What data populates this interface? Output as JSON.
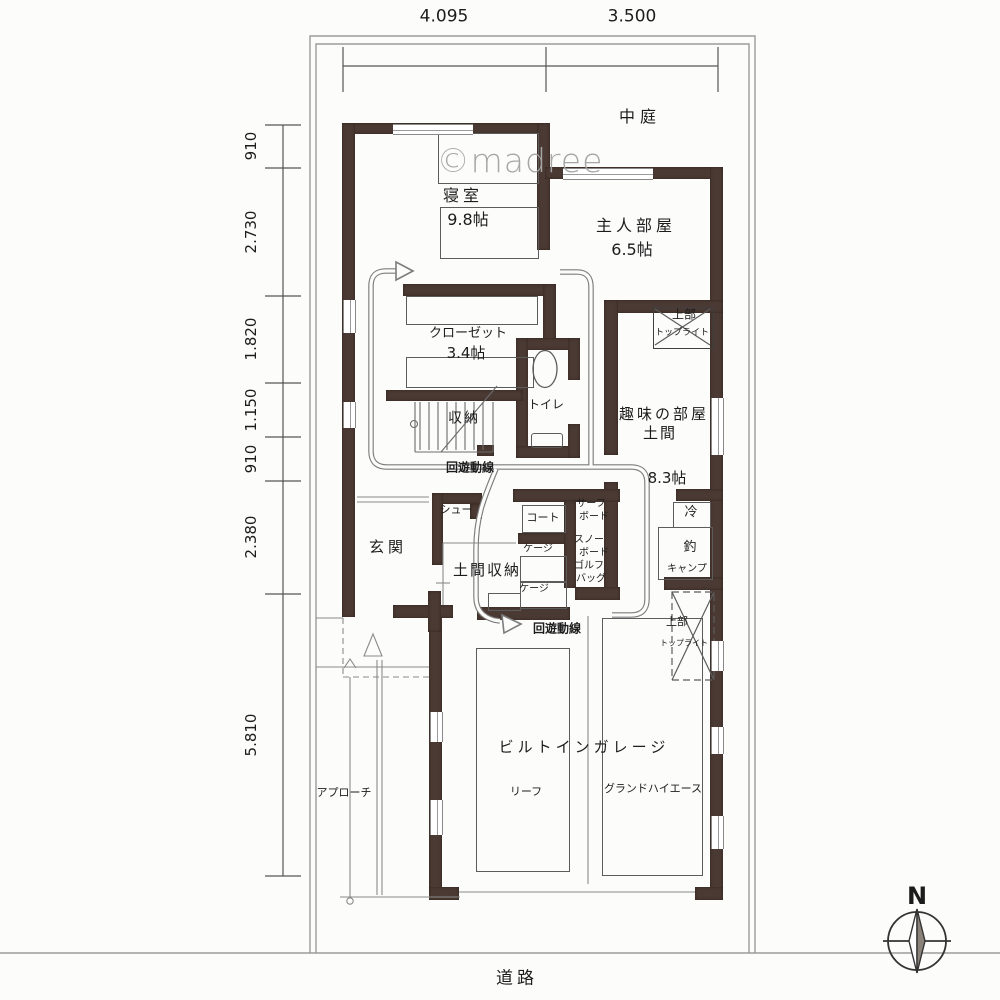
{
  "watermark": "©madree",
  "site": {
    "courtyard": "中庭",
    "road": "道路",
    "approach": "アプローチ",
    "north": "N"
  },
  "dimensions": {
    "top": [
      "4.095",
      "3.500"
    ],
    "left": [
      "910",
      "2.730",
      "1.820",
      "1.150",
      "910",
      "2.380",
      "5.810"
    ]
  },
  "rooms": {
    "bedroom": {
      "name": "寝室",
      "size": "9.8帖"
    },
    "master": {
      "name": "主人部屋",
      "size": "6.5帖"
    },
    "closet": {
      "name": "クローゼット",
      "size": "3.4帖"
    },
    "toilet": {
      "name": "トイレ"
    },
    "storage": {
      "name": "収納"
    },
    "hobby": {
      "name": "趣味の部屋",
      "floor": "土間",
      "size": "8.3帖"
    },
    "genkan": {
      "name": "玄関"
    },
    "doma_storage": {
      "name": "土間収納"
    },
    "garage": {
      "name": "ビルトインガレージ"
    }
  },
  "items": {
    "shoe": "シュー",
    "coat": "コート",
    "surfboard_l1": "サーフ",
    "surfboard_l2": "ボード",
    "snowboard_l1": "スノー",
    "snowboard_l2": "ボード",
    "golfbag_l1": "ゴルフ",
    "golfbag_l2": "バッグ",
    "cage_a": "ケージ",
    "cage_b": "ケージ",
    "fridge": "冷",
    "fishing": "釣",
    "camp": "キャンプ",
    "car_left": "リーフ",
    "car_right": "グランドハイエース"
  },
  "annotations": {
    "circulation_a": "回遊動線",
    "circulation_b": "回遊動線",
    "skylight_hobby_l1": "上部",
    "skylight_hobby_l2": "トップライト",
    "skylight_garage_l1": "上部",
    "skylight_garage_l2": "トップライト"
  },
  "colors": {
    "wall": "#4b3a33",
    "line": "#7d7d7d",
    "watermark": "#a6a6a6"
  }
}
